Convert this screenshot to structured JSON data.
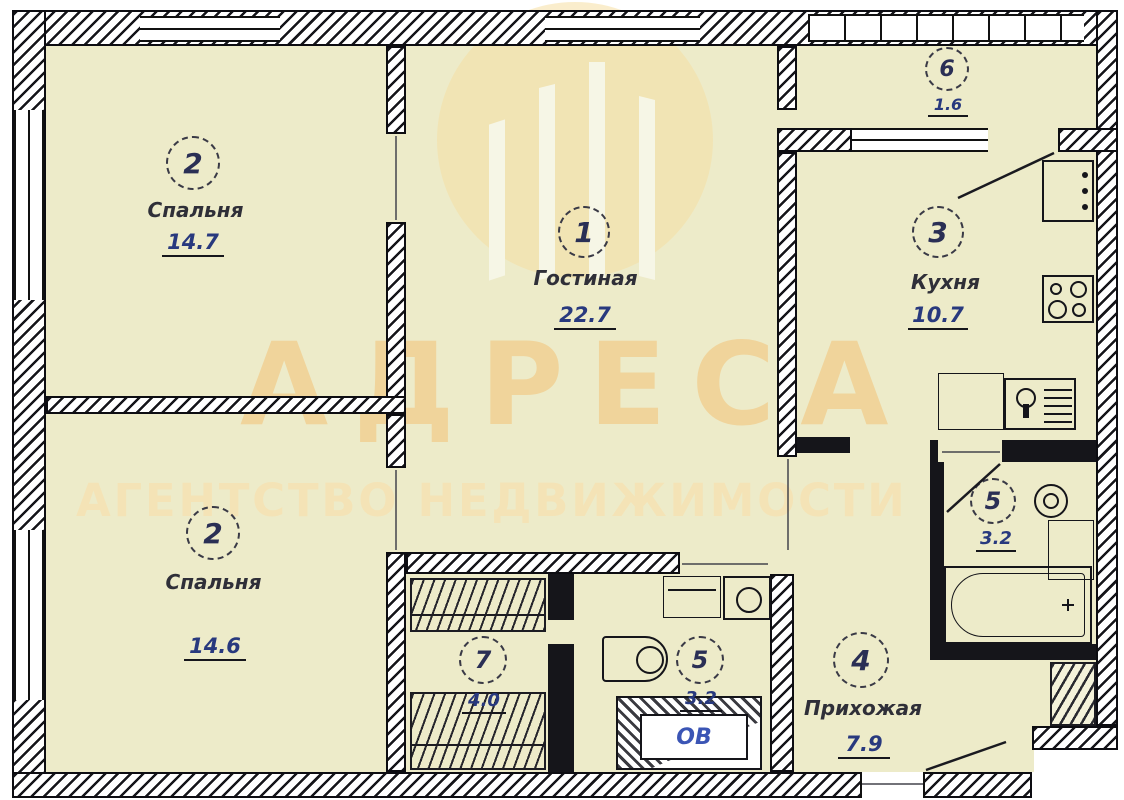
{
  "watermark": {
    "title": "АДРЕСА",
    "subtitle": "АГЕНТСТВО НЕДВИЖИМОСТИ",
    "logo": "building-in-circle"
  },
  "rooms": [
    {
      "id": "bedroom-top",
      "number": "2",
      "name": "Спальня",
      "area": "14.7"
    },
    {
      "id": "living-room",
      "number": "1",
      "name": "Гостиная",
      "area": "22.7"
    },
    {
      "id": "kitchen",
      "number": "3",
      "name": "Кухня",
      "area": "10.7"
    },
    {
      "id": "balcony",
      "number": "6",
      "name": "",
      "area": "1.6"
    },
    {
      "id": "bedroom-bottom",
      "number": "2",
      "name": "Спальня",
      "area": "14.6"
    },
    {
      "id": "wardrobe-room",
      "number": "7",
      "name": "",
      "area": "4.0"
    },
    {
      "id": "bathroom-middle",
      "number": "5",
      "name": "",
      "area": "3.2"
    },
    {
      "id": "hallway",
      "number": "4",
      "name": "Прихожая",
      "area": "7.9"
    },
    {
      "id": "bathroom-right",
      "number": "5",
      "name": "",
      "area": "3.2"
    }
  ],
  "labels": {
    "vent_shaft": "ОВ"
  },
  "colors": {
    "room_fill": "#EDEBC9",
    "wall": "#15151A",
    "area_text": "#28397E",
    "watermark_title": "#F1CE8F",
    "watermark_subtitle": "#F5E3B5",
    "watermark_logo": "#F6E0A4"
  }
}
